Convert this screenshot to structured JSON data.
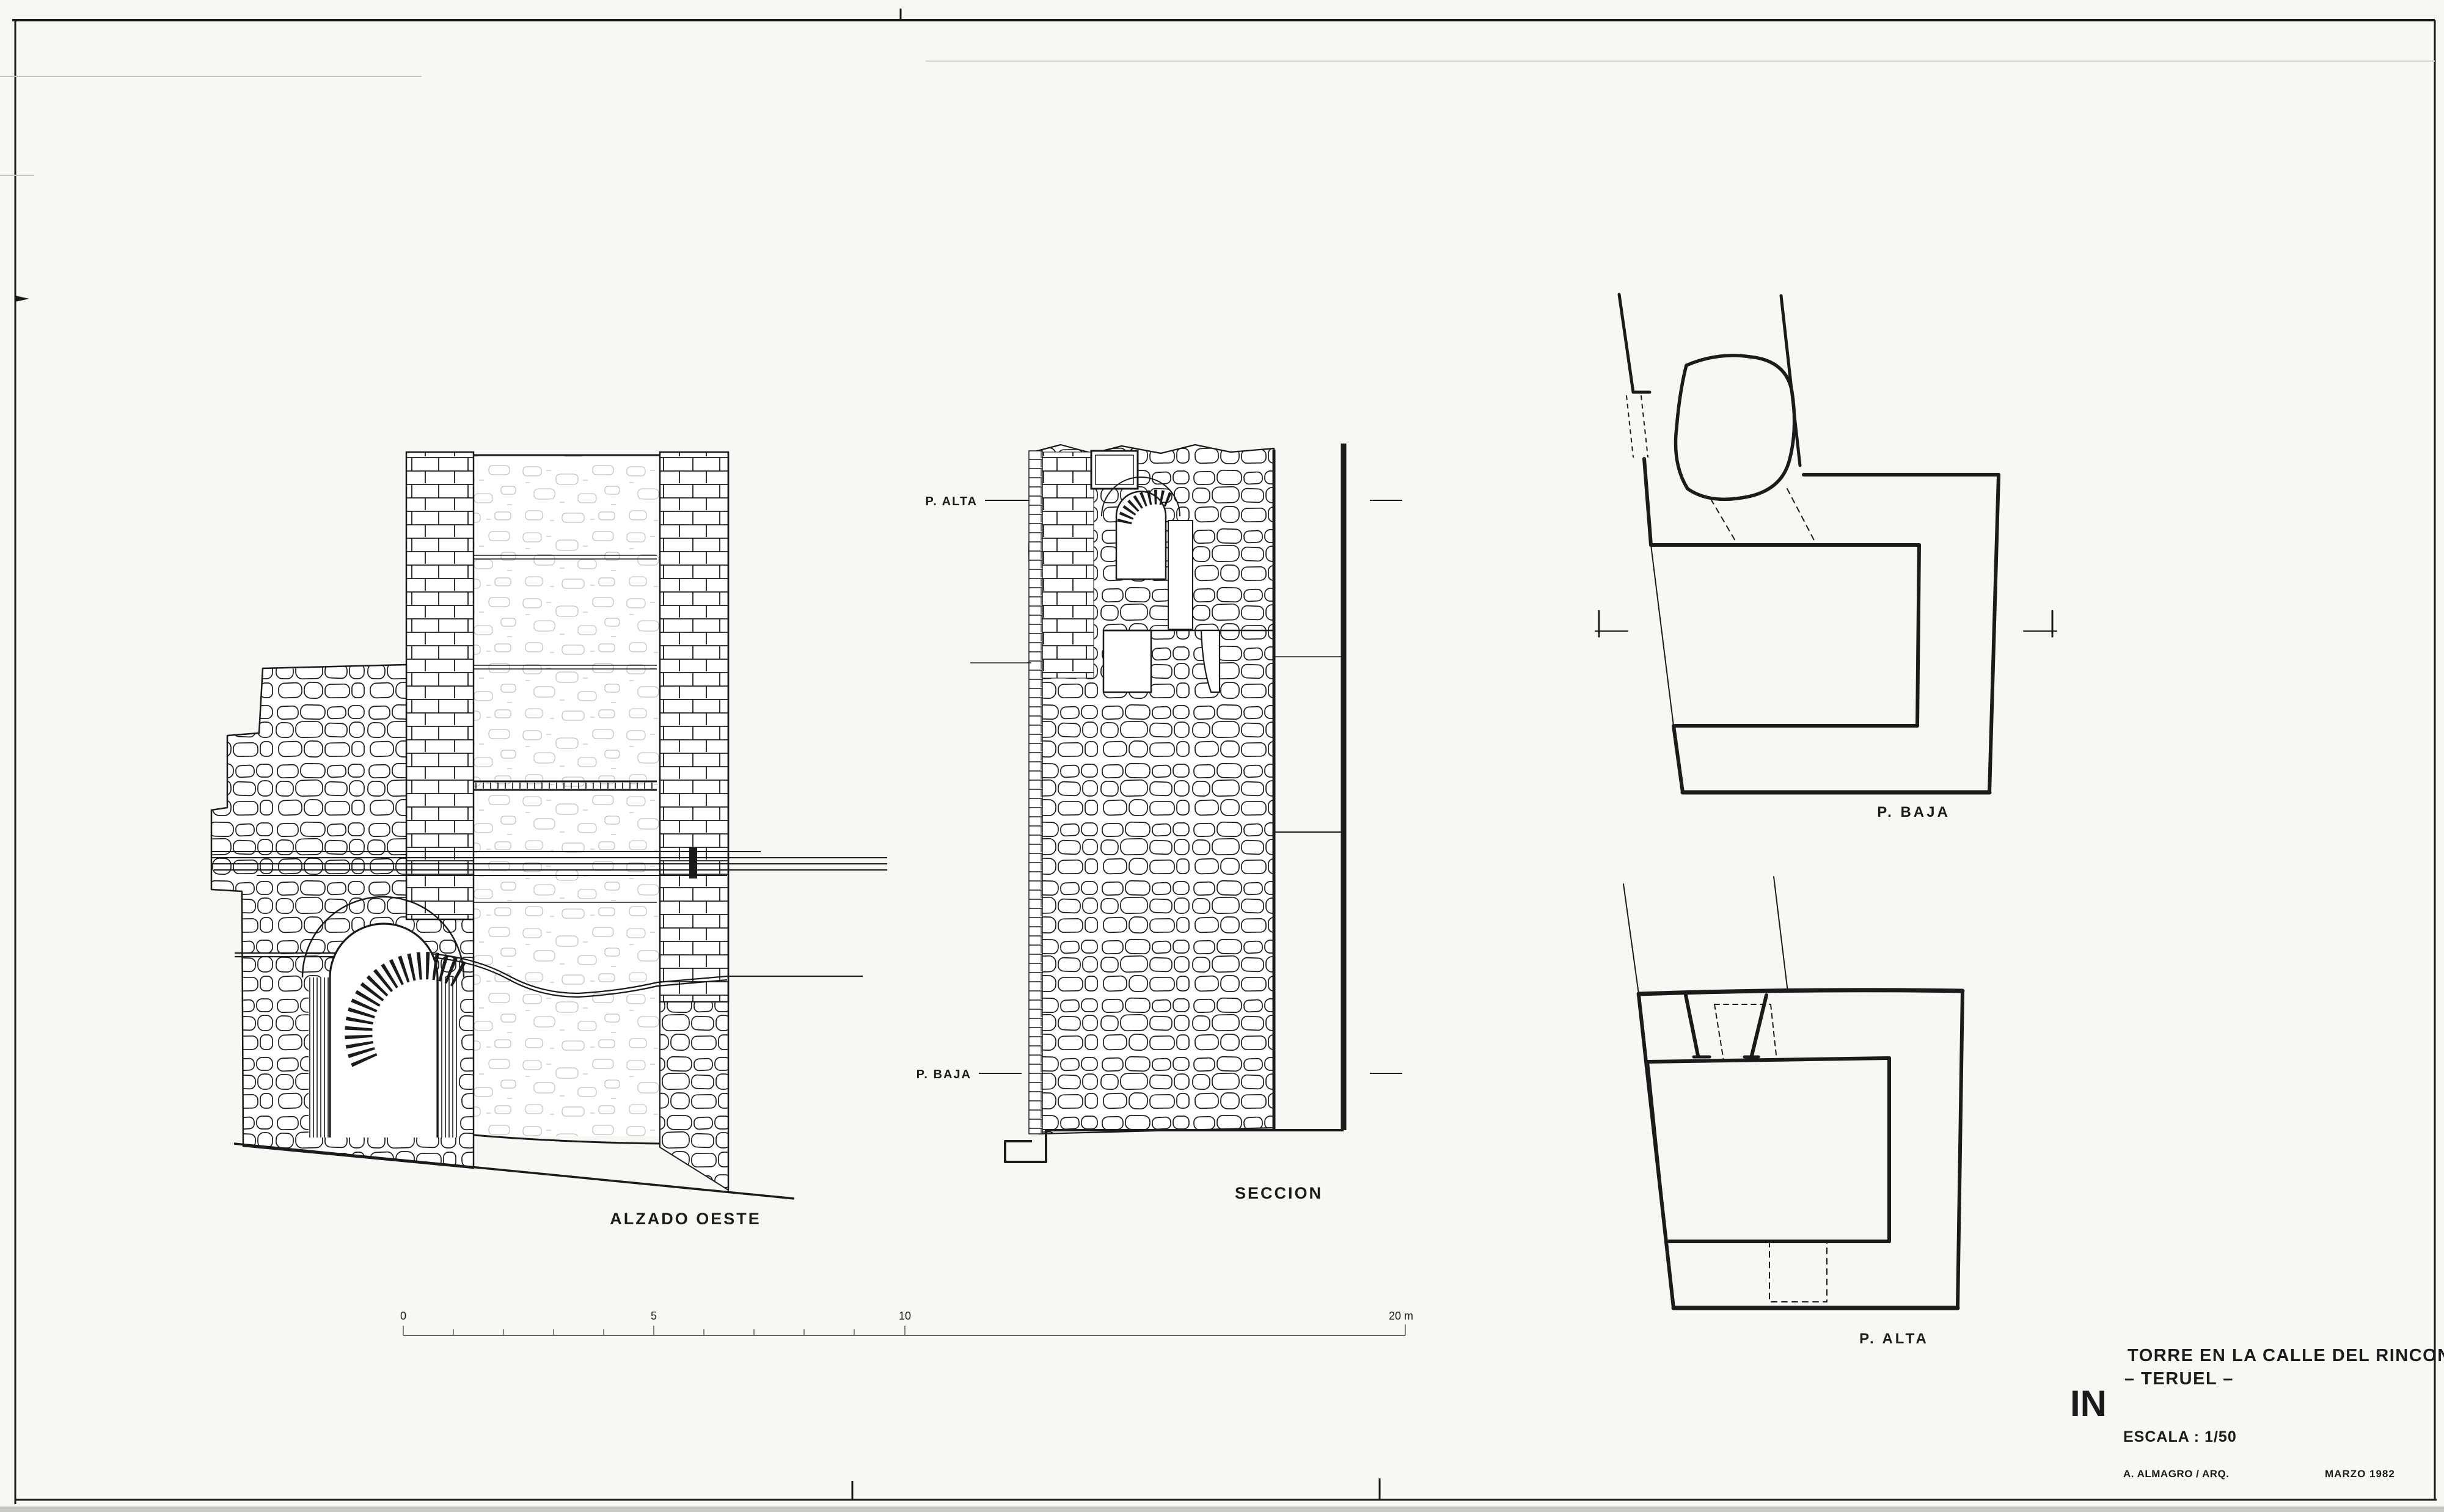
{
  "sheet": {
    "paper_color": "#f7f7f3",
    "ink_color": "#1b1b1b",
    "faint_line_color": "#c7c7c0"
  },
  "title_block": {
    "sheet_code": "IN",
    "line1": "TORRE EN LA CALLE DEL RINCON",
    "line2": "– TERUEL –",
    "scale_label": "ESCALA : 1/50",
    "author": "A. ALMAGRO / ARQ.",
    "date": "MARZO 1982"
  },
  "labels": {
    "elevation": "ALZADO OESTE",
    "section": "SECCION",
    "section_upper": "P. ALTA",
    "section_lower": "P. BAJA",
    "plan_ground": "P. BAJA",
    "plan_upper": "P. ALTA"
  },
  "scale_bar": {
    "t0": "0",
    "t5": "5",
    "t10": "10",
    "end": "20 m"
  }
}
